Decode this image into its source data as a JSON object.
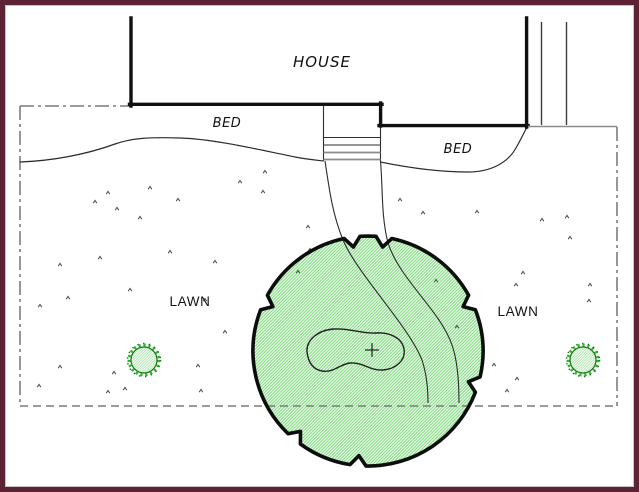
{
  "labels": {
    "house": "HOUSE",
    "bed_left": "BED",
    "bed_right": "BED",
    "lawn_left": "LAWN",
    "lawn_right": "LAWN"
  },
  "colors": {
    "frame": "#5d2334",
    "ink": "#101010",
    "canopy-ink": "#0d0d0d",
    "line": "#2e2e2e",
    "gray": "#8a8a8a",
    "dash": "#5f5f5f",
    "hatch-green": "#87de87",
    "hatch-light": "#aee3ae",
    "shrub-green": "#2eb52e",
    "shrub-dark": "#147514",
    "tuft": "#4a4a4a"
  }
}
